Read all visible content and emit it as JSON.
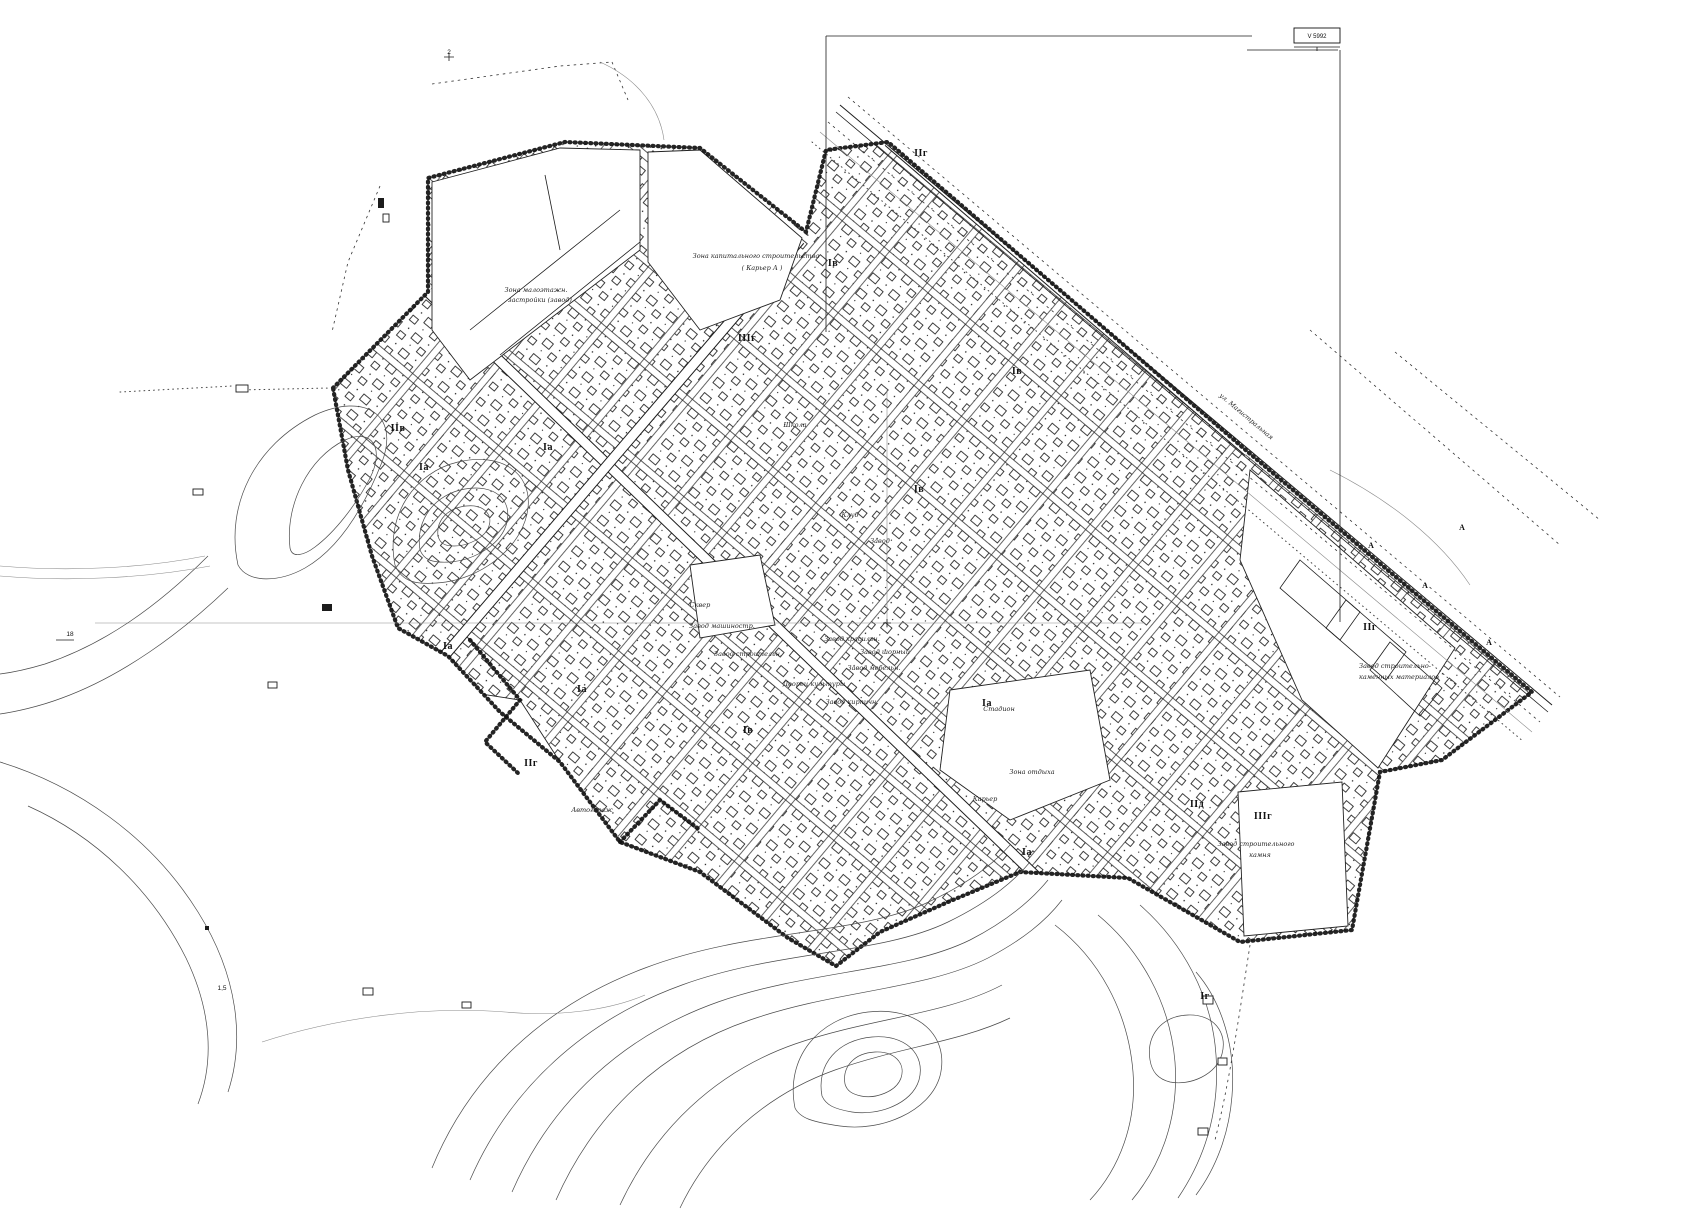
{
  "map": {
    "kind": "scanned town general-plan sheet",
    "colors": {
      "paper": "#ffffff",
      "ink": "#1c1c1c",
      "contour": "#4a4a4a",
      "faint": "#8a8a8a"
    },
    "scale_box": {
      "label": "V 5992"
    },
    "labels": {
      "zones": [
        {
          "text": "IIг",
          "x": 921,
          "y": 156
        },
        {
          "text": "Iв",
          "x": 833,
          "y": 266
        },
        {
          "text": "IIIг",
          "x": 747,
          "y": 341
        },
        {
          "text": "Iв",
          "x": 1017,
          "y": 374
        },
        {
          "text": "IIв",
          "x": 398,
          "y": 431
        },
        {
          "text": "Iа",
          "x": 548,
          "y": 450
        },
        {
          "text": "Iа",
          "x": 424,
          "y": 470
        },
        {
          "text": "Iв",
          "x": 919,
          "y": 492
        },
        {
          "text": "Iа",
          "x": 448,
          "y": 649
        },
        {
          "text": "Iа",
          "x": 582,
          "y": 692
        },
        {
          "text": "Iв",
          "x": 748,
          "y": 733
        },
        {
          "text": "Iа",
          "x": 987,
          "y": 706
        },
        {
          "text": "IIг",
          "x": 531,
          "y": 766
        },
        {
          "text": "IIг",
          "x": 1370,
          "y": 630
        },
        {
          "text": "IIд",
          "x": 1197,
          "y": 807
        },
        {
          "text": "IIIг",
          "x": 1263,
          "y": 819
        },
        {
          "text": "Iа",
          "x": 1027,
          "y": 855
        },
        {
          "text": "Iг",
          "x": 1205,
          "y": 999
        }
      ],
      "annotations": [
        {
          "text": "Зона капитального строительства",
          "x": 756,
          "y": 258
        },
        {
          "text": "( Карьер А )",
          "x": 762,
          "y": 270
        },
        {
          "text": "Зона малоэтажн.",
          "x": 536,
          "y": 292
        },
        {
          "text": "застройки (завод)",
          "x": 540,
          "y": 302
        },
        {
          "text": "Школа",
          "x": 795,
          "y": 427
        },
        {
          "text": "Клуб",
          "x": 850,
          "y": 517
        },
        {
          "text": "Завод",
          "x": 880,
          "y": 543
        },
        {
          "text": "Сквер",
          "x": 700,
          "y": 607
        },
        {
          "text": "Завод машиностр.",
          "x": 722,
          "y": 628
        },
        {
          "text": "Завод строительн.",
          "x": 748,
          "y": 656
        },
        {
          "text": "Завод красильн.",
          "x": 852,
          "y": 641
        },
        {
          "text": "Завод шорный",
          "x": 885,
          "y": 654
        },
        {
          "text": "Завод мебельн.",
          "x": 874,
          "y": 670
        },
        {
          "text": "Дворец культуры",
          "x": 814,
          "y": 686
        },
        {
          "text": "Завод кирпичн.",
          "x": 852,
          "y": 704
        },
        {
          "text": "Стадион",
          "x": 999,
          "y": 711
        },
        {
          "text": "Автогараж",
          "x": 592,
          "y": 812
        },
        {
          "text": "Зона отдыха",
          "x": 1032,
          "y": 774
        },
        {
          "text": "Карьер",
          "x": 985,
          "y": 801
        },
        {
          "text": "Завод строительно-",
          "x": 1395,
          "y": 668
        },
        {
          "text": "каменных материалов",
          "x": 1399,
          "y": 679
        },
        {
          "text": "Завод строительного",
          "x": 1256,
          "y": 846
        },
        {
          "text": "камня",
          "x": 1260,
          "y": 857
        },
        {
          "text": "ул. Магистральная",
          "x": 1245,
          "y": 418,
          "rot": 40
        }
      ],
      "marks": [
        {
          "text": "А",
          "x": 1371,
          "y": 548
        },
        {
          "text": "А",
          "x": 1425,
          "y": 588
        },
        {
          "text": "А",
          "x": 1489,
          "y": 645
        },
        {
          "text": "А",
          "x": 1462,
          "y": 530
        }
      ],
      "ticks": [
        {
          "text": "2",
          "x": 449,
          "y": 54
        },
        {
          "text": "18",
          "x": 70,
          "y": 636
        },
        {
          "text": "1,5",
          "x": 222,
          "y": 990
        }
      ]
    }
  }
}
